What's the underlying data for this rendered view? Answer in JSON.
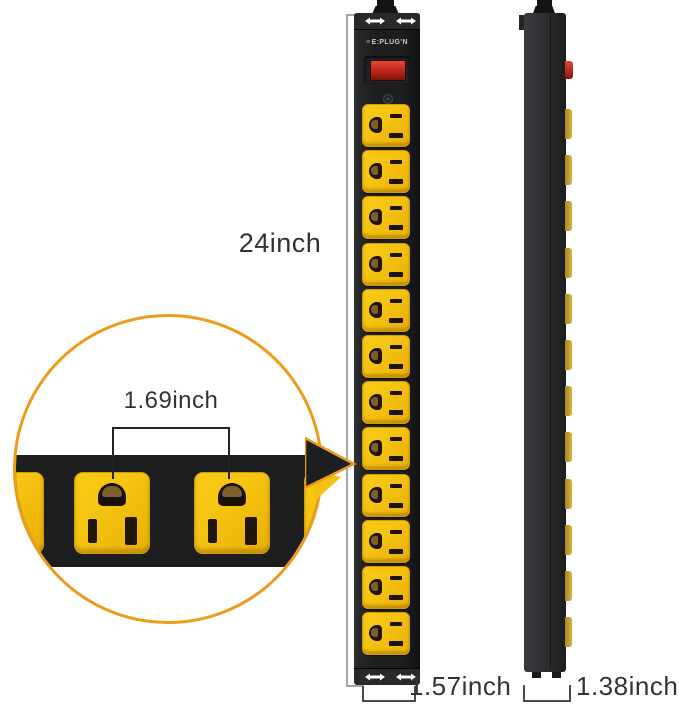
{
  "figure": {
    "type": "product-dimension-diagram",
    "product": "vertical power strip, front and side views with zoom detail",
    "brand": "E:PLUG'N",
    "outlet_count": 12
  },
  "annotations": {
    "height_label": "24inch",
    "spacing_label": "1.69inch",
    "front_width_label": "1.57inch",
    "side_depth_label": "1.38inch"
  },
  "colors": {
    "outlet_yellow": "#F5C211",
    "accent_orange": "#EE9B1C",
    "body_black": "#1D1E20",
    "switch_red": "#C1271C",
    "dim_line": "#A6A6A6",
    "bracket_line": "#4A4A4A",
    "text": "#333333"
  }
}
